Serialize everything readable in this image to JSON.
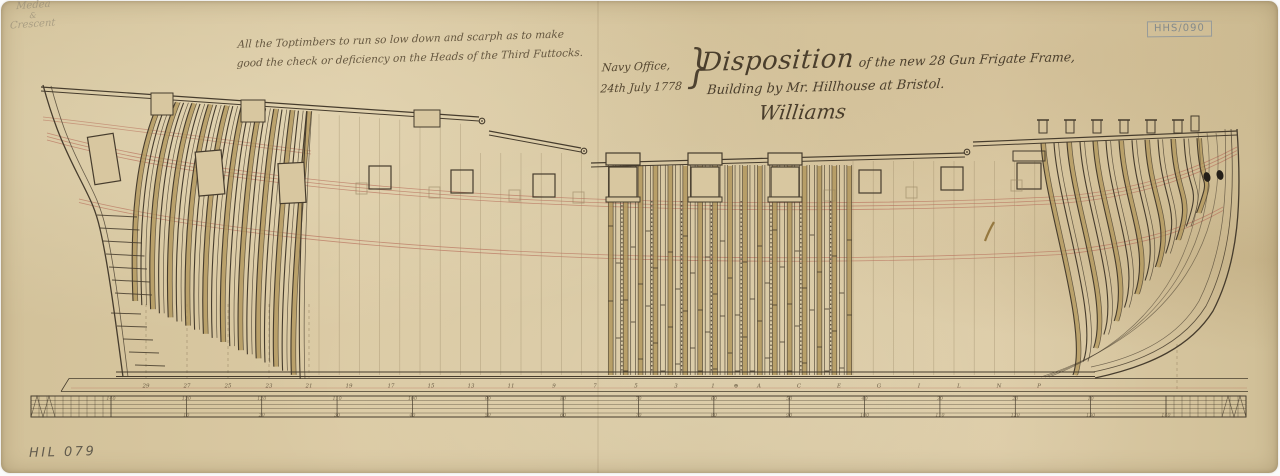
{
  "document": {
    "stamp": "HHS/090",
    "reference": "HIL 079"
  },
  "annotations": {
    "note_line1": "All the Toptimbers to run so low down and scarph as to make",
    "note_line2": "good the check or deficiency on the Heads of the Third Futtocks.",
    "office_line1": "Navy Office,",
    "office_line2": "24th July 1778",
    "brace": "}",
    "title_word": "Disposition",
    "title_rest": "of the new 28 Gun Frigate Frame,",
    "title_line2": "Building by Mr. Hillhouse at Bristol.",
    "signature": "Williams",
    "pencil_line1": "Medea",
    "pencil_line2": "&",
    "pencil_line3": "Crescent"
  },
  "drawing": {
    "stations": [
      {
        "label": "29",
        "x": 145
      },
      {
        "label": "27",
        "x": 186
      },
      {
        "label": "25",
        "x": 227
      },
      {
        "label": "23",
        "x": 268
      },
      {
        "label": "21",
        "x": 308
      },
      {
        "label": "19",
        "x": 348
      },
      {
        "label": "17",
        "x": 390
      },
      {
        "label": "15",
        "x": 430
      },
      {
        "label": "13",
        "x": 470
      },
      {
        "label": "11",
        "x": 510
      },
      {
        "label": "9",
        "x": 553
      },
      {
        "label": "7",
        "x": 594
      },
      {
        "label": "5",
        "x": 635
      },
      {
        "label": "3",
        "x": 675
      },
      {
        "label": "1",
        "x": 712
      },
      {
        "label": "⊕",
        "x": 735
      },
      {
        "label": "A",
        "x": 758
      },
      {
        "label": "C",
        "x": 798
      },
      {
        "label": "E",
        "x": 838
      },
      {
        "label": "G",
        "x": 878
      },
      {
        "label": "I",
        "x": 918
      },
      {
        "label": "L",
        "x": 958
      },
      {
        "label": "N",
        "x": 998
      },
      {
        "label": "P",
        "x": 1038
      }
    ],
    "scale_top": [
      "140",
      "130",
      "120",
      "110",
      "100",
      "90",
      "80",
      "70",
      "60",
      "50",
      "40",
      "30",
      "20",
      "10"
    ],
    "scale_bottom": [
      "10",
      "20",
      "30",
      "40",
      "50",
      "60",
      "70",
      "80",
      "90",
      "100",
      "110",
      "120",
      "130",
      "140"
    ]
  },
  "colors": {
    "paper": "#d8c7a0",
    "ink": "#463c2d",
    "timber": "#b0955a",
    "red_line": "#b8705c",
    "faint": "#93815f",
    "label": "#6a5c44"
  }
}
